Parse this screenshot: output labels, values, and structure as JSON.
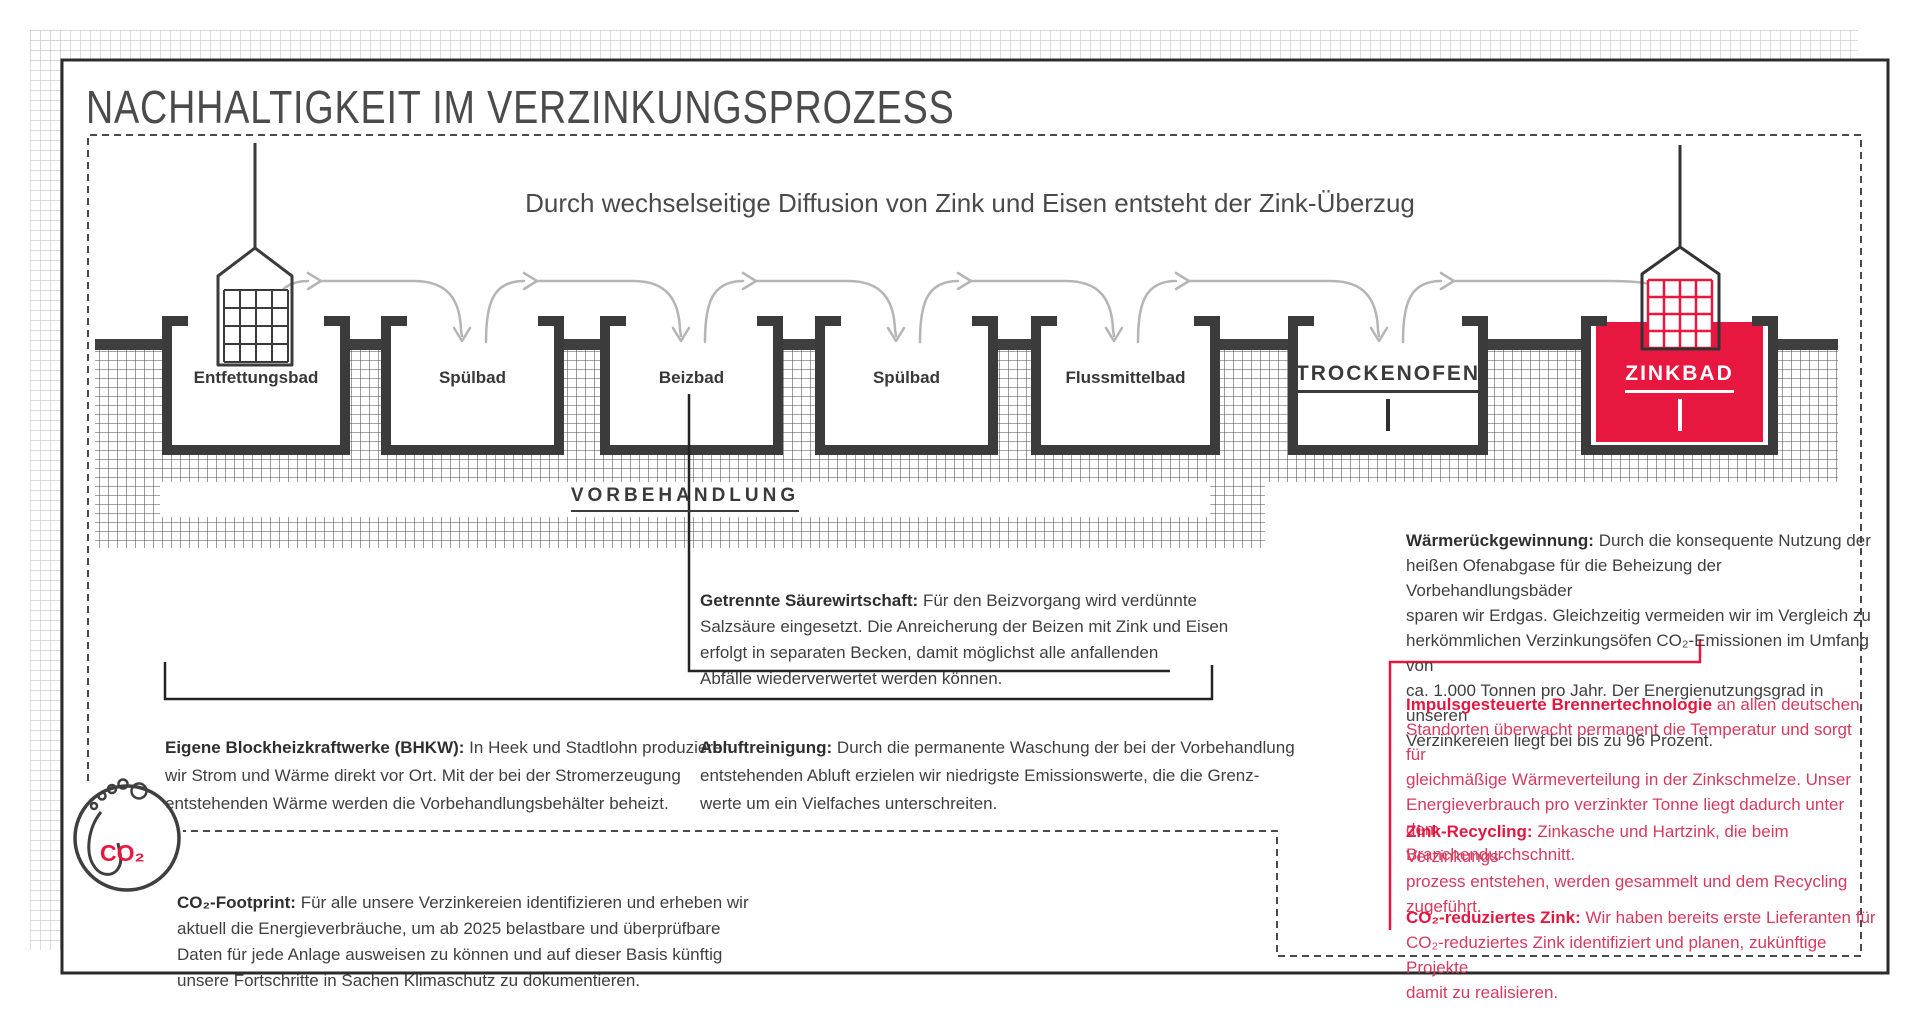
{
  "title": "NACHHALTIGKEIT IM VERZINKUNGSPROZESS",
  "subtitle": "Durch wechselseitige Diffusion von Zink und Eisen entsteht der Zink-Überzug",
  "baths": [
    {
      "label": "Entfettungsbad"
    },
    {
      "label": "Spülbad"
    },
    {
      "label": "Beizbad"
    },
    {
      "label": "Spülbad"
    },
    {
      "label": "Flussmittelbad"
    },
    {
      "label": "TROCKENOFEN"
    },
    {
      "label": "ZINKBAD"
    }
  ],
  "section_label": "VORBEHANDLUNG",
  "blocks": {
    "getrennte": {
      "head": "Getrennte Säurewirtschaft:",
      "body": " Für den Beizvorgang wird verdünnte\nSalzsäure eingesetzt. Die Anreicherung der Beizen mit Zink und Eisen\nerfolgt in separaten Becken, damit möglichst alle anfallenden\nAbfälle wiederverwertet werden können."
    },
    "bhkw": {
      "head": "Eigene Blockheizkraftwerke (BHKW):",
      "body": " In Heek und Stadtlohn produzieren\nwir Strom und Wärme direkt vor Ort. Mit der bei der Stromerzeugung\nentstehenden Wärme werden die Vorbehandlungsbehälter beheizt."
    },
    "abluft": {
      "head": "Abluftreinigung:",
      "body": " Durch die permanente Waschung der bei der Vorbehandlung\nentstehenden Abluft erzielen wir niedrigste Emissionswerte, die die Grenz-\nwerte um ein Vielfaches unterschreiten."
    },
    "waerme": {
      "head": "Wärmerückgewinnung:",
      "body": " Durch die konsequente Nutzung der\nheißen Ofenabgase für die Beheizung der Vorbehandlungsbäder\nsparen wir Erdgas. Gleichzeitig vermeiden wir im Vergleich zu\nherkömmlichen Verzinkungsöfen CO₂-Emissionen im Umfang von\nca. 1.000 Tonnen pro Jahr. Der Energienutzungsgrad in unseren\nVerzinkereien liegt bei bis zu 96 Prozent."
    },
    "impuls": {
      "head": "Impulsgesteuerte Brennertechnologie",
      "body": " an allen deutschen\nStandorten überwacht permanent die Temperatur und sorgt für\ngleichmäßige Wärmeverteilung in der Zinkschmelze. Unser\nEnergieverbrauch pro verzinkter Tonne liegt dadurch unter dem\nBranchendurchschnitt."
    },
    "zink_recycling": {
      "head": "Zink-Recycling:",
      "body": " Zinkasche und Hartzink, die beim Verzinkungs-\nprozess entstehen, werden gesammelt und dem Recycling\nzugeführt."
    },
    "co2_zink": {
      "head": "CO₂-reduziertes Zink:",
      "body": " Wir haben bereits erste Lieferanten für\nCO₂-reduziertes Zink identifiziert und planen, zukünftige Projekte\ndamit zu realisieren."
    },
    "co2_footprint": {
      "head": "CO₂-Footprint:",
      "body": " Für alle unsere Verzinkereien identifizieren und erheben wir\naktuell die Energieverbräuche, um ab 2025 belastbare und überprüfbare\nDaten für jede Anlage ausweisen zu können und auf dieser Basis künftig\nunsere Fortschritte in Sachen Klimaschutz zu dokumentieren."
    }
  },
  "co2_icon_label": "CO₂",
  "colors": {
    "accent_red": "#e8173f",
    "text_dark": "#3a3a3a",
    "arrow_gray": "#b5b5b5",
    "hatch_line": "#4e4e4e",
    "page_grid": "#c6c6c6"
  }
}
